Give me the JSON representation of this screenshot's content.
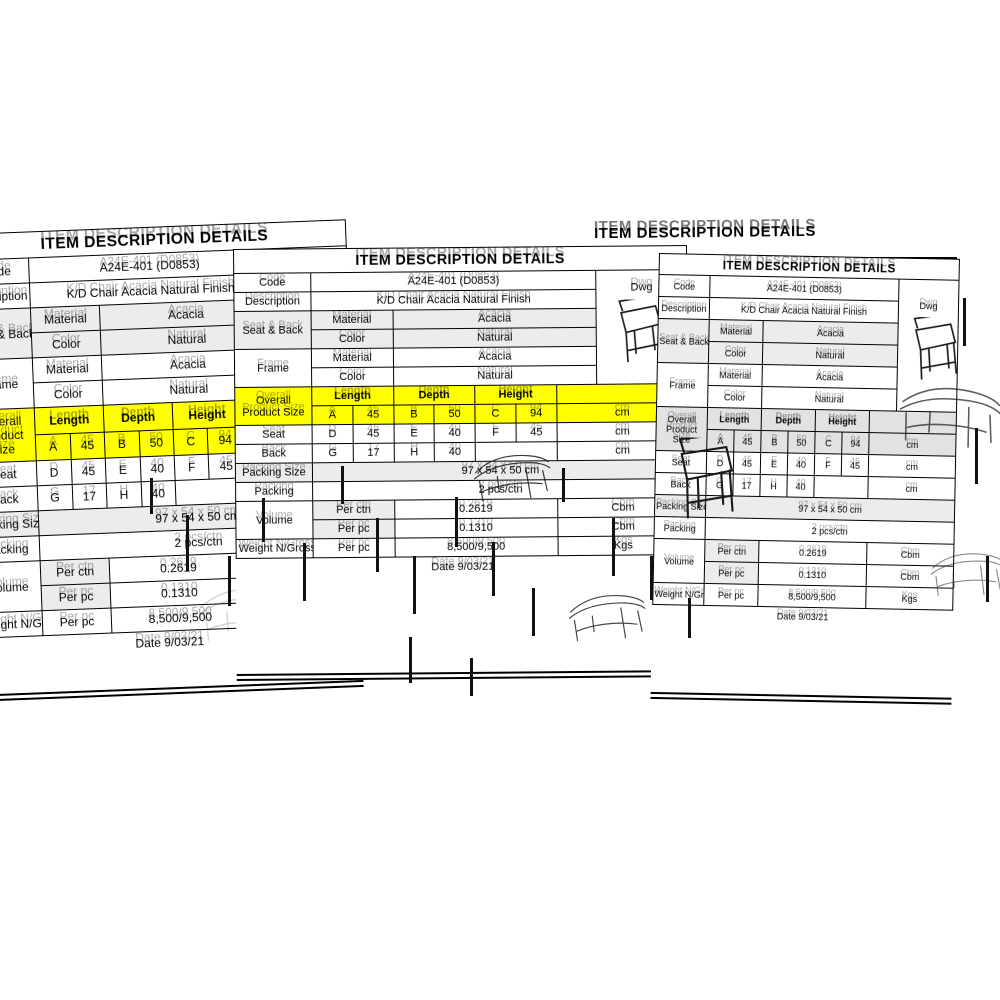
{
  "page": {
    "background": "#ffffff"
  },
  "colors": {
    "highlight_yellow": "#ffff00",
    "row_shade": "#ececec",
    "line_black": "#000000",
    "paper_white": "#ffffff"
  },
  "sheet": {
    "title": "ITEM DESCRIPTION DETAILS",
    "code_label": "Code",
    "code_value": "A24E-401 (D0853)",
    "dwg_label": "Dwg",
    "description_label": "Description",
    "description_value": "K/D Chair Acacia Natural Finish",
    "material_label": "Material",
    "color_label": "Color",
    "seat_back_label": "Seat & Back",
    "seat_back_material": "Acacia",
    "seat_back_color": "Natural",
    "frame_label": "Frame",
    "frame_material": "Acacia",
    "frame_color": "Natural",
    "size": {
      "overall_label": "Overall Product Size",
      "length_label": "Length",
      "depth_label": "Depth",
      "height_label": "Height",
      "unit": "cm",
      "A": "A",
      "A_value": "45",
      "B": "B",
      "B_value": "50",
      "C": "C",
      "C_value": "94",
      "seat_label": "Seat",
      "D": "D",
      "D_value": "45",
      "E": "E",
      "E_value": "40",
      "F": "F",
      "F_value": "45",
      "back_label": "Back",
      "G": "G",
      "G_value": "17",
      "H": "H",
      "H_value": "40"
    },
    "packing_size_label": "Packing Size",
    "packing_size_value": "97 x 54 x 50 cm",
    "packing_label": "Packing",
    "packing_value": "2 pcs/ctn",
    "volume_label": "Volume",
    "volume": {
      "r1_name": "Per ctn",
      "r1_value": "0.2619",
      "r1_unit": "Cbm",
      "r2_name": "Per pc",
      "r2_value": "0.1310",
      "r2_unit": "Cbm"
    },
    "weight_label": "Weight N/Gross",
    "weight_name": "Per pc",
    "weight_value": "8,500/9,500",
    "weight_unit": "Kgs",
    "date_text": "Date 9/03/21"
  }
}
